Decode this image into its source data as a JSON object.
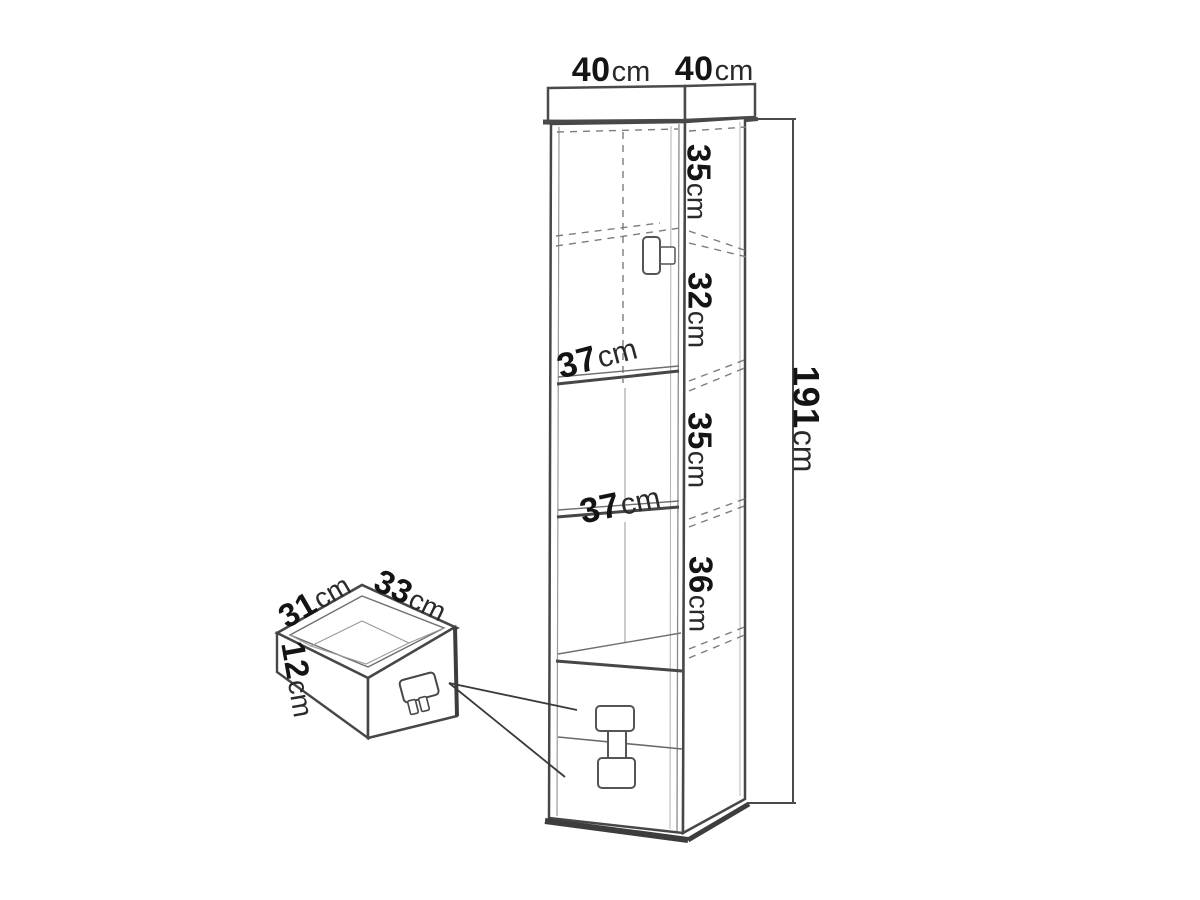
{
  "diagram": {
    "name": "tall-cabinet-dimension-diagram",
    "unit_system": "cm",
    "colors": {
      "background": "#ffffff",
      "line_main": "#474747",
      "line_thick": "#3d3d3d",
      "line_light": "#9a9a9a",
      "line_dashed": "#7d7d7d",
      "text": "#141414"
    },
    "labels": {
      "top_width_front": {
        "value": "40",
        "unit": "cm"
      },
      "top_depth_side": {
        "value": "40",
        "unit": "cm"
      },
      "section_1_height": {
        "value": "35",
        "unit": "cm"
      },
      "section_2_height": {
        "value": "32",
        "unit": "cm"
      },
      "shelf_1_depth": {
        "value": "37",
        "unit": "cm"
      },
      "section_3_height": {
        "value": "35",
        "unit": "cm"
      },
      "shelf_2_depth": {
        "value": "37",
        "unit": "cm"
      },
      "section_4_height": {
        "value": "36",
        "unit": "cm"
      },
      "total_height": {
        "value": "191",
        "unit": "cm"
      },
      "drawer_side_depth": {
        "value": "31",
        "unit": "cm"
      },
      "drawer_front_width": {
        "value": "33",
        "unit": "cm"
      },
      "drawer_height": {
        "value": "12",
        "unit": "cm"
      }
    }
  }
}
